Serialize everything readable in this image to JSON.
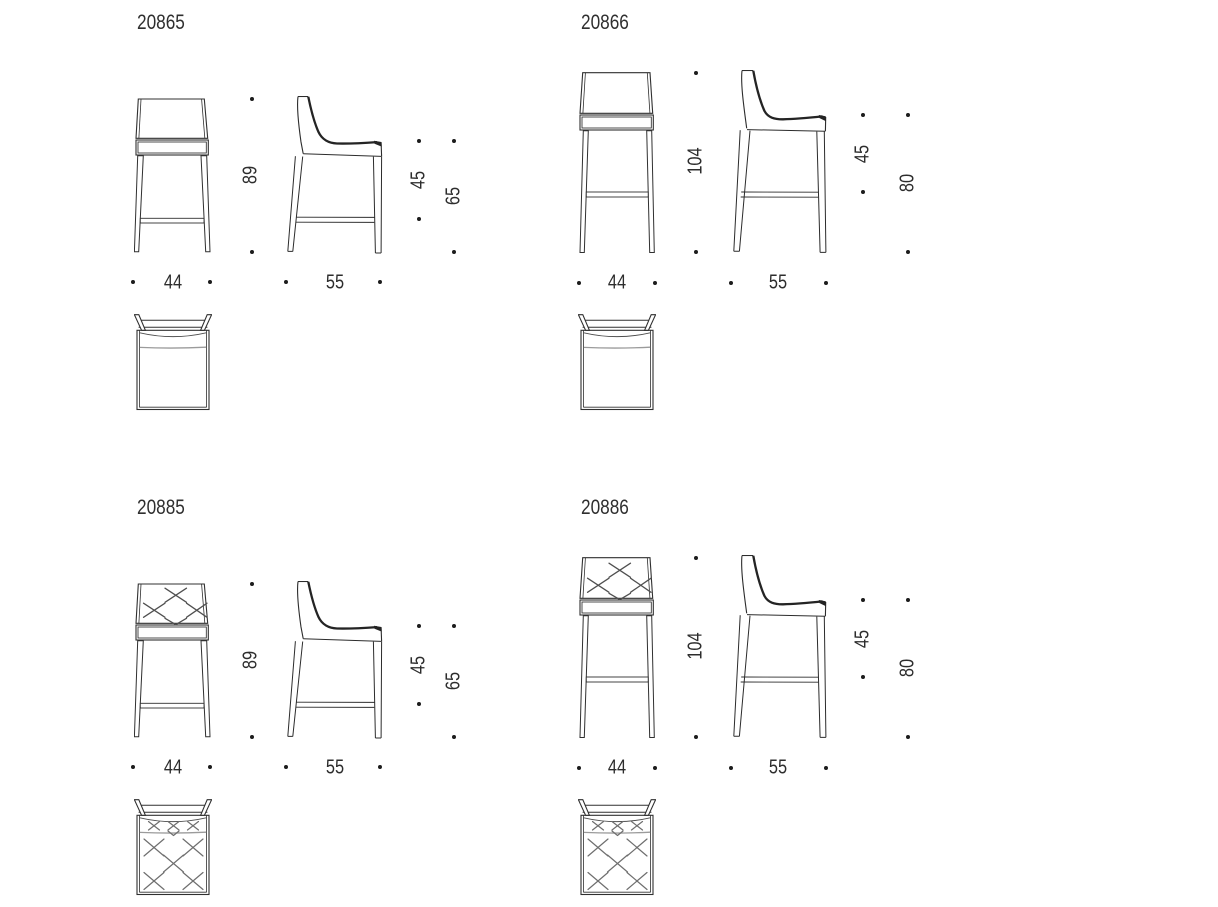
{
  "document": {
    "kind": "bar stool technical drawing sheet",
    "background": "#ffffff",
    "line_color": "#303030",
    "soft_line_color": "#9b9b9b",
    "dot_color": "#1c1c1c"
  },
  "products": [
    {
      "code": "20865",
      "quilted": false,
      "size": "short",
      "dimensions": {
        "overall_height": "89",
        "backrest_height": "45",
        "seat_height": "65",
        "width": "44",
        "depth": "55"
      }
    },
    {
      "code": "20866",
      "quilted": false,
      "size": "tall",
      "dimensions": {
        "overall_height": "104",
        "backrest_height": "45",
        "seat_height": "80",
        "width": "44",
        "depth": "55"
      }
    },
    {
      "code": "20885",
      "quilted": true,
      "size": "short",
      "dimensions": {
        "overall_height": "89",
        "backrest_height": "45",
        "seat_height": "65",
        "width": "44",
        "depth": "55"
      }
    },
    {
      "code": "20886",
      "quilted": true,
      "size": "tall",
      "dimensions": {
        "overall_height": "104",
        "backrest_height": "45",
        "seat_height": "80",
        "width": "44",
        "depth": "55"
      }
    }
  ]
}
